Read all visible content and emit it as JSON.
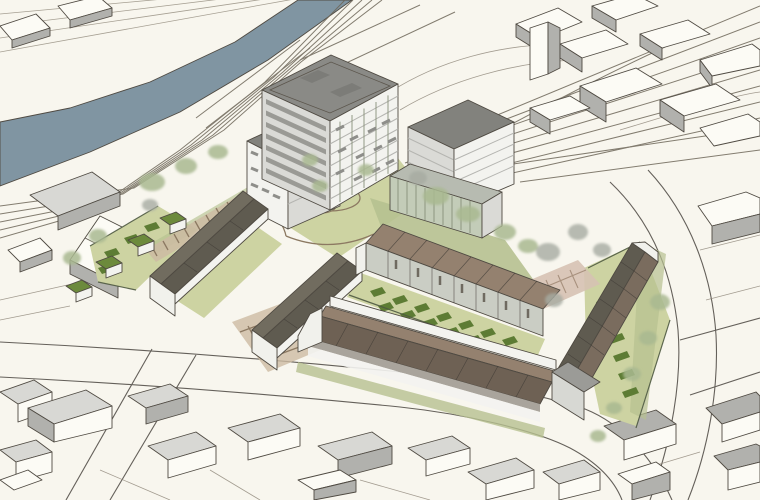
{
  "scene": {
    "type": "architectural-aerial-sketch",
    "description": "Hand-drawn style aerial visualisation of a riverside housing masterplan: apartment blocks, terraced houses with gardens, a landscaped courtyard, parking courts, surrounding streets, railway corridor and river.",
    "labels": [
      "river",
      "railway corridor",
      "apartment tower",
      "midrise blocks",
      "terraced housing",
      "row houses",
      "private gardens",
      "landscaped courtyard",
      "parking court",
      "paved court",
      "garden sheds",
      "boundary planting",
      "context buildings",
      "streets"
    ]
  },
  "palette": {
    "paper": "#f8f6ee",
    "river": "#8095a2",
    "context_face": "#fcfbf5",
    "context_shade": "#b1b1ad",
    "context_roof": "#d8d8d4",
    "tower_roof": "#8a8a86",
    "face_light": "#dadad6",
    "face_white": "#f3f3ef",
    "window_band": "#8e8e8a",
    "midrise_roof": "#82827d",
    "glass_green": "#c3ccb8",
    "glass_roof": "#b7bbb1",
    "terrace_brown": "#94816f",
    "terrace_brown_dark": "#6e6154",
    "row_roof_dark": "#5f5b50",
    "row_roof_mid": "#716c5f",
    "facade_grey": "#cacdc4",
    "green_light": "#cdd3a2",
    "green_mid": "#b6c190",
    "green_dark": "#5d7c34",
    "tree_sage": "#a9b890",
    "tree_grey": "#a6aba1",
    "path_tan": "#cdbba3",
    "court_pink": "#d6c2b2",
    "shed_roof": "#6c8a3c",
    "eave_shade": "#a9a49c",
    "gable_white": "#f1f1ec"
  }
}
